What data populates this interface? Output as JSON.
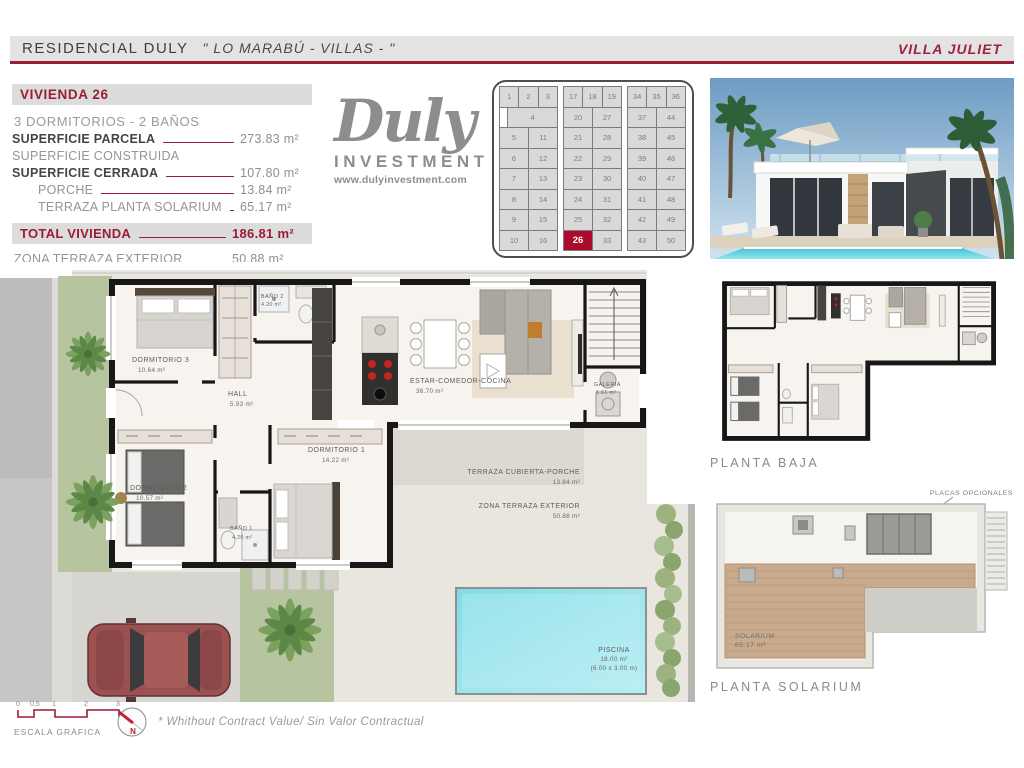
{
  "header": {
    "project": "RESIDENCIAL DULY",
    "quote": "\" LO MARABÚ - VILLAS - \"",
    "villa": "VILLA JULIET"
  },
  "info_panel": {
    "title": "VIVIENDA 26",
    "subtitle": "3 DORMITORIOS - 2 BAÑOS",
    "rows": [
      {
        "label": "SUPERFICIE PARCELA",
        "value": "273.83 m²",
        "bold": true,
        "indent": 0,
        "line": true
      },
      {
        "label": "SUPERFICIE CONSTRUIDA",
        "value": "",
        "bold": false,
        "indent": 0,
        "line": false
      },
      {
        "label": "SUPERFICIE CERRADA",
        "value": "107.80 m²",
        "bold": true,
        "indent": 0,
        "line": true
      },
      {
        "label": "PORCHE",
        "value": "13.84 m²",
        "bold": false,
        "indent": 1,
        "line": true
      },
      {
        "label": "TERRAZA PLANTA SOLARIUM",
        "value": "65.17 m²",
        "bold": false,
        "indent": 1,
        "line": true
      }
    ],
    "total": {
      "label": "TOTAL VIVIENDA",
      "value": "186.81 m²"
    },
    "extra": {
      "label": "ZONA TERRAZA EXTERIOR",
      "value": "50.88 m²"
    }
  },
  "logo": {
    "brand": "Duly",
    "division": "INVESTMENT",
    "website": "www.dulyinvestment.com"
  },
  "plot_grid": {
    "highlight": "26",
    "highlight_color": "#ab0c2d",
    "groups": [
      {
        "top": [
          "1",
          "2",
          "3"
        ],
        "special_row": {
          "wide": "4"
        },
        "rows": [
          [
            "5",
            "11"
          ],
          [
            "6",
            "12"
          ],
          [
            "7",
            "13"
          ],
          [
            "8",
            "14"
          ],
          [
            "9",
            "15"
          ],
          [
            "10",
            "16"
          ]
        ]
      },
      {
        "top": [
          "17",
          "18",
          "19"
        ],
        "rows": [
          [
            "20",
            "27"
          ],
          [
            "21",
            "28"
          ],
          [
            "22",
            "29"
          ],
          [
            "23",
            "30"
          ],
          [
            "24",
            "31"
          ],
          [
            "25",
            "32"
          ],
          [
            "26",
            "33"
          ]
        ]
      },
      {
        "top": [
          "34",
          "35",
          "36"
        ],
        "rows": [
          [
            "37",
            "44"
          ],
          [
            "38",
            "45"
          ],
          [
            "39",
            "46"
          ],
          [
            "40",
            "47"
          ],
          [
            "41",
            "48"
          ],
          [
            "42",
            "49"
          ],
          [
            "43",
            "50"
          ]
        ]
      }
    ]
  },
  "floor_plan": {
    "rooms": {
      "dorm3": {
        "name": "DORMITORIO 3",
        "area": "10.64 m²"
      },
      "bano2": {
        "name": "BAÑO 2",
        "area": "4.20 m²"
      },
      "hall": {
        "name": "HALL",
        "area": "5.93 m²"
      },
      "estar": {
        "name": "ESTAR-COMEDOR-COCINA",
        "area": "36.70 m²"
      },
      "galeria": {
        "name": "GALERIA",
        "area": "1.61 m²"
      },
      "dorm1": {
        "name": "DORMITORIO 1",
        "area": "14.22 m²"
      },
      "dorm2": {
        "name": "DORMITORIO 2",
        "area": "10.57 m²"
      },
      "bano1": {
        "name": "BAÑO 1",
        "area": "4.20 m²"
      },
      "porche": {
        "name": "TERRAZA CUBIERTA-PORCHE",
        "area": "13.84 m²"
      },
      "terraza": {
        "name": "ZONA TERRAZA EXTERIOR",
        "area": "50.88 m²"
      },
      "piscina": {
        "name": "PISCINA",
        "area": "18.00 m²",
        "dims": "(6.00 x 3.00 m)"
      }
    }
  },
  "thumbs": {
    "planta_baja": "PLANTA BAJA",
    "planta_solarium": "PLANTA SOLARIUM",
    "annotation": "PLACAS OPCIONALES",
    "solarium_room": "SOLARIUM",
    "solarium_area": "65.17 m²"
  },
  "footer": {
    "scale_ticks": [
      "0",
      "0,5",
      "1",
      "2",
      "3"
    ],
    "scale_label": "ESCALA GRÁFICA",
    "north": "N",
    "disclaimer": "* Whithout Contract Value/ Sin Valor Contractual"
  }
}
